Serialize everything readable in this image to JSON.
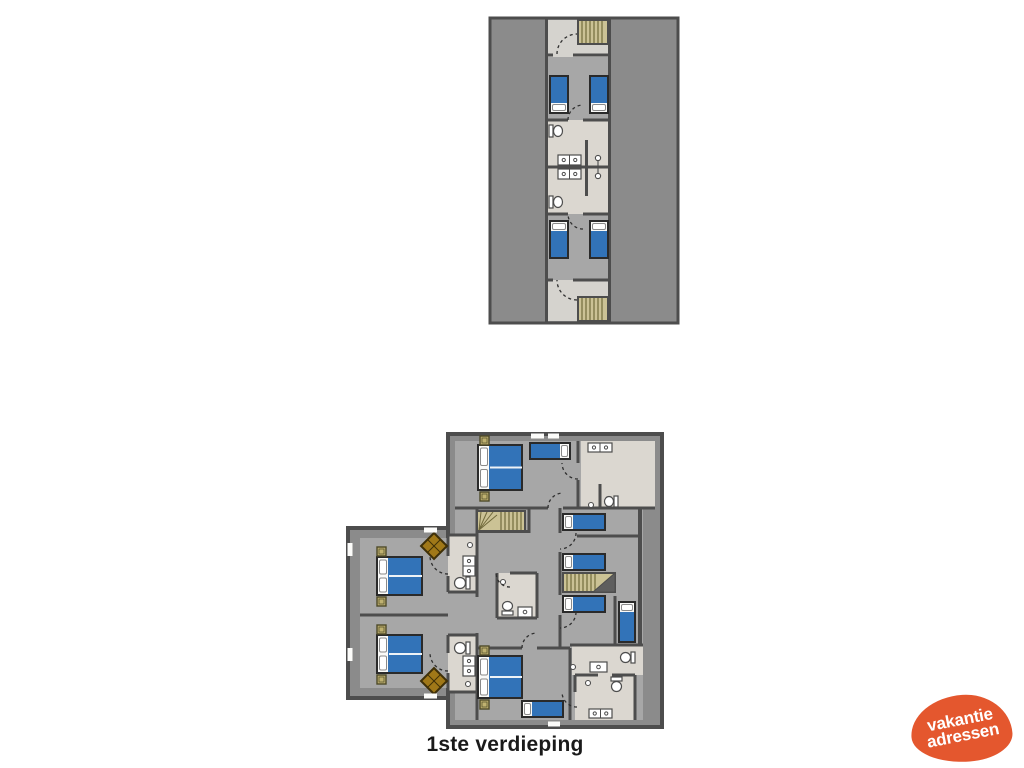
{
  "caption": {
    "text": "1ste verdieping"
  },
  "logo": {
    "line1": "vakantie",
    "line2": "adressen",
    "color": "#e4572e",
    "text_color": "#ffffff"
  },
  "palette": {
    "roof": "#8b8b8b",
    "wall": "#4d4d4d",
    "floor": "#a7a7a7",
    "hall": "#d5d3ce",
    "bath": "#dbd7d0",
    "bed_blue": "#3273b8",
    "bed_blue_dark": "#1e4c86",
    "linen": "#fafaf8",
    "stair_fill": "#cbc295",
    "stair_line": "#716a3c",
    "stair_tri": "#5e5e5e",
    "nightstand": "#bfb170",
    "wood": "#a07818",
    "wood_dark": "#3f3008",
    "white": "#fcfcfa",
    "fixture_stroke": "#4d4d4d",
    "arc": "#2f2f2f"
  },
  "plans": [
    {
      "name": "upper-floor-plan",
      "items": [
        {
          "t": "rect",
          "x": 490,
          "y": 18,
          "w": 188,
          "h": 305,
          "f": "roof",
          "s": "wall",
          "sw": 3,
          "n": "roof-area"
        },
        {
          "t": "rect",
          "x": 548,
          "y": 20,
          "w": 60,
          "h": 37,
          "f": "hall",
          "n": "hallway-floor"
        },
        {
          "t": "rect",
          "x": 548,
          "y": 57,
          "w": 60,
          "h": 63,
          "f": "floor",
          "n": "bedroom-floor"
        },
        {
          "t": "rect",
          "x": 548,
          "y": 120,
          "w": 60,
          "h": 94,
          "f": "bath",
          "n": "bathroom-floor"
        },
        {
          "t": "rect",
          "x": 548,
          "y": 214,
          "w": 60,
          "h": 66,
          "f": "floor",
          "n": "bedroom-floor"
        },
        {
          "t": "rect",
          "x": 548,
          "y": 280,
          "w": 60,
          "h": 41,
          "f": "hall",
          "n": "hallway-floor"
        },
        {
          "t": "line",
          "x1": 546.5,
          "y1": 18,
          "x2": 546.5,
          "y2": 323,
          "w": 3
        },
        {
          "t": "line",
          "x1": 609.5,
          "y1": 18,
          "x2": 609.5,
          "y2": 323,
          "w": 3
        },
        {
          "t": "stairs",
          "x": 578,
          "y": 20,
          "w": 30,
          "h": 24,
          "o": "v"
        },
        {
          "t": "line",
          "x1": 548,
          "y1": 55,
          "x2": 553,
          "y2": 55,
          "w": 3
        },
        {
          "t": "line",
          "x1": 573,
          "y1": 55,
          "x2": 608,
          "y2": 55,
          "w": 3
        },
        {
          "t": "line",
          "x1": 548,
          "y1": 120,
          "x2": 568,
          "y2": 120,
          "w": 3
        },
        {
          "t": "line",
          "x1": 583,
          "y1": 120,
          "x2": 608,
          "y2": 120,
          "w": 3
        },
        {
          "t": "line",
          "x1": 548,
          "y1": 167,
          "x2": 608,
          "y2": 167,
          "w": 3
        },
        {
          "t": "line",
          "x1": 548,
          "y1": 214,
          "x2": 568,
          "y2": 214,
          "w": 3
        },
        {
          "t": "line",
          "x1": 583,
          "y1": 214,
          "x2": 608,
          "y2": 214,
          "w": 3
        },
        {
          "t": "line",
          "x1": 548,
          "y1": 280,
          "x2": 553,
          "y2": 280,
          "w": 3
        },
        {
          "t": "line",
          "x1": 573,
          "y1": 280,
          "x2": 608,
          "y2": 280,
          "w": 3
        },
        {
          "t": "line",
          "x1": 586.5,
          "y1": 140,
          "x2": 586.5,
          "y2": 196,
          "w": 3
        },
        {
          "t": "bed",
          "x": 550,
          "y": 76,
          "w": 18,
          "h": 37,
          "p": "b"
        },
        {
          "t": "bed",
          "x": 590,
          "y": 76,
          "w": 18,
          "h": 37,
          "p": "b"
        },
        {
          "t": "bed",
          "x": 550,
          "y": 221,
          "w": 18,
          "h": 37,
          "p": "t"
        },
        {
          "t": "bed",
          "x": 590,
          "y": 221,
          "w": 18,
          "h": 37,
          "p": "t"
        },
        {
          "t": "wc",
          "x": 549,
          "y": 125,
          "w": 14,
          "h": 12,
          "o": "e"
        },
        {
          "t": "wc",
          "x": 549,
          "y": 196,
          "w": 14,
          "h": 12,
          "o": "e"
        },
        {
          "t": "sink2",
          "x": 558,
          "y": 155,
          "w": 23,
          "h": 10
        },
        {
          "t": "sink2",
          "x": 558,
          "y": 169,
          "w": 23,
          "h": 10
        },
        {
          "t": "shower",
          "x": 598,
          "y": 167
        },
        {
          "t": "stairs",
          "x": 578,
          "y": 297,
          "w": 30,
          "h": 24,
          "o": "v"
        },
        {
          "t": "arc",
          "x": 577,
          "y": 54,
          "r": 20,
          "a0": 180,
          "a1": 270
        },
        {
          "t": "arc",
          "x": 583,
          "y": 120,
          "r": 15,
          "a0": 180,
          "a1": 270
        },
        {
          "t": "arc",
          "x": 583,
          "y": 214,
          "r": 15,
          "a0": 90,
          "a1": 180
        },
        {
          "t": "arc",
          "x": 577,
          "y": 280,
          "r": 20,
          "a0": 90,
          "a1": 180
        }
      ]
    },
    {
      "name": "first-floor-plan",
      "items": [
        {
          "t": "rect",
          "x": 448,
          "y": 434,
          "w": 214,
          "h": 293,
          "f": "roof",
          "s": "wall",
          "sw": 4,
          "n": "roof-area"
        },
        {
          "t": "rect",
          "x": 348,
          "y": 528,
          "w": 100,
          "h": 170,
          "f": "roof",
          "s": "wall",
          "sw": 4,
          "n": "roof-area"
        },
        {
          "t": "rect",
          "x": 455,
          "y": 441,
          "w": 200,
          "h": 279,
          "f": "floor",
          "n": "floor-area"
        },
        {
          "t": "rect",
          "x": 360,
          "y": 538,
          "w": 95,
          "h": 150,
          "f": "floor",
          "n": "left-wing-floor"
        },
        {
          "t": "rect",
          "x": 643,
          "y": 508,
          "w": 12,
          "h": 212,
          "f": "roof",
          "n": "roof-strip"
        },
        {
          "t": "rect",
          "x": 581,
          "y": 441,
          "w": 74,
          "h": 67,
          "f": "bath",
          "n": "bathroom-floor"
        },
        {
          "t": "rect",
          "x": 497,
          "y": 573,
          "w": 40,
          "h": 45,
          "f": "bath",
          "n": "bathroom-floor"
        },
        {
          "t": "rect",
          "x": 448,
          "y": 535,
          "w": 29,
          "h": 57,
          "f": "bath",
          "n": "bathroom-floor"
        },
        {
          "t": "rect",
          "x": 448,
          "y": 635,
          "w": 29,
          "h": 57,
          "f": "bath",
          "n": "bathroom-floor"
        },
        {
          "t": "rect",
          "x": 572,
          "y": 645,
          "w": 71,
          "h": 30,
          "f": "bath",
          "n": "bathroom-floor"
        },
        {
          "t": "rect",
          "x": 575,
          "y": 675,
          "w": 60,
          "h": 45,
          "f": "bath",
          "n": "bathroom-floor"
        },
        {
          "t": "line",
          "x1": 578,
          "y1": 441,
          "x2": 578,
          "y2": 463,
          "w": 3
        },
        {
          "t": "line",
          "x1": 578,
          "y1": 480,
          "x2": 578,
          "y2": 508,
          "w": 3
        },
        {
          "t": "line",
          "x1": 600,
          "y1": 484,
          "x2": 600,
          "y2": 508,
          "w": 3
        },
        {
          "t": "line",
          "x1": 455,
          "y1": 508,
          "x2": 548,
          "y2": 508,
          "w": 3
        },
        {
          "t": "line",
          "x1": 563,
          "y1": 508,
          "x2": 655,
          "y2": 508,
          "w": 3
        },
        {
          "t": "line",
          "x1": 477,
          "y1": 531.5,
          "x2": 529,
          "y2": 531.5,
          "w": 3
        },
        {
          "t": "line",
          "x1": 529,
          "y1": 508,
          "x2": 529,
          "y2": 533,
          "w": 3
        },
        {
          "t": "line",
          "x1": 477,
          "y1": 508,
          "x2": 477,
          "y2": 597,
          "w": 3
        },
        {
          "t": "line",
          "x1": 477,
          "y1": 633,
          "x2": 477,
          "y2": 720,
          "w": 3
        },
        {
          "t": "line",
          "x1": 448,
          "y1": 535,
          "x2": 477,
          "y2": 535,
          "w": 3
        },
        {
          "t": "line",
          "x1": 448,
          "y1": 592,
          "x2": 477,
          "y2": 592,
          "w": 3
        },
        {
          "t": "line",
          "x1": 448,
          "y1": 635,
          "x2": 477,
          "y2": 635,
          "w": 3
        },
        {
          "t": "line",
          "x1": 448,
          "y1": 692,
          "x2": 477,
          "y2": 692,
          "w": 3
        },
        {
          "t": "line",
          "x1": 448,
          "y1": 535,
          "x2": 448,
          "y2": 556,
          "w": 3
        },
        {
          "t": "line",
          "x1": 448,
          "y1": 576,
          "x2": 448,
          "y2": 592,
          "w": 3
        },
        {
          "t": "line",
          "x1": 448,
          "y1": 635,
          "x2": 448,
          "y2": 653,
          "w": 3
        },
        {
          "t": "line",
          "x1": 448,
          "y1": 673,
          "x2": 448,
          "y2": 692,
          "w": 3
        },
        {
          "t": "line",
          "x1": 360,
          "y1": 615,
          "x2": 448,
          "y2": 615,
          "w": 3
        },
        {
          "t": "line",
          "x1": 560,
          "y1": 508,
          "x2": 560,
          "y2": 533,
          "w": 3
        },
        {
          "t": "line",
          "x1": 560,
          "y1": 552,
          "x2": 560,
          "y2": 595,
          "w": 3
        },
        {
          "t": "line",
          "x1": 560,
          "y1": 615,
          "x2": 560,
          "y2": 648,
          "w": 3
        },
        {
          "t": "line",
          "x1": 577,
          "y1": 536,
          "x2": 640,
          "y2": 536,
          "w": 3
        },
        {
          "t": "line",
          "x1": 640,
          "y1": 508,
          "x2": 640,
          "y2": 645,
          "w": 4
        },
        {
          "t": "line",
          "x1": 615,
          "y1": 596,
          "x2": 615,
          "y2": 645,
          "w": 3
        },
        {
          "t": "line",
          "x1": 570,
          "y1": 645,
          "x2": 643,
          "y2": 645,
          "w": 3
        },
        {
          "t": "line",
          "x1": 570,
          "y1": 648,
          "x2": 570,
          "y2": 720,
          "w": 3
        },
        {
          "t": "line",
          "x1": 477,
          "y1": 648,
          "x2": 522,
          "y2": 648,
          "w": 3
        },
        {
          "t": "line",
          "x1": 537,
          "y1": 648,
          "x2": 570,
          "y2": 648,
          "w": 3
        },
        {
          "t": "line",
          "x1": 575,
          "y1": 675,
          "x2": 598,
          "y2": 675,
          "w": 3
        },
        {
          "t": "line",
          "x1": 612,
          "y1": 675,
          "x2": 635,
          "y2": 675,
          "w": 3
        },
        {
          "t": "line",
          "x1": 635,
          "y1": 675,
          "x2": 635,
          "y2": 720,
          "w": 3
        },
        {
          "t": "line",
          "x1": 575,
          "y1": 675,
          "x2": 575,
          "y2": 692,
          "w": 3
        },
        {
          "t": "line",
          "x1": 510,
          "y1": 573,
          "x2": 537,
          "y2": 573,
          "w": 3
        },
        {
          "t": "line",
          "x1": 497,
          "y1": 573,
          "x2": 497,
          "y2": 618,
          "w": 3
        },
        {
          "t": "line",
          "x1": 497,
          "y1": 618,
          "x2": 537,
          "y2": 618,
          "w": 3
        },
        {
          "t": "line",
          "x1": 537,
          "y1": 573,
          "x2": 537,
          "y2": 618,
          "w": 3
        },
        {
          "t": "stairs",
          "x": 477,
          "y": 511,
          "w": 48,
          "h": 20,
          "o": "v",
          "fan": "w"
        },
        {
          "t": "stairs",
          "x": 563,
          "y": 573,
          "w": 52,
          "h": 19,
          "o": "v",
          "tri": "e"
        },
        {
          "t": "bed",
          "x": 478,
          "y": 445,
          "w": 44,
          "h": 45,
          "p": "l",
          "d": 1
        },
        {
          "t": "bed",
          "x": 530,
          "y": 443,
          "w": 40,
          "h": 16,
          "p": "r"
        },
        {
          "t": "bed",
          "x": 563,
          "y": 514,
          "w": 42,
          "h": 16,
          "p": "l"
        },
        {
          "t": "bed",
          "x": 563,
          "y": 554,
          "w": 42,
          "h": 16,
          "p": "l"
        },
        {
          "t": "bed",
          "x": 563,
          "y": 596,
          "w": 42,
          "h": 16,
          "p": "l"
        },
        {
          "t": "bed",
          "x": 619,
          "y": 602,
          "w": 16,
          "h": 40,
          "p": "t"
        },
        {
          "t": "bed",
          "x": 377,
          "y": 557,
          "w": 45,
          "h": 38,
          "p": "l",
          "d": 1
        },
        {
          "t": "bed",
          "x": 377,
          "y": 635,
          "w": 45,
          "h": 38,
          "p": "l",
          "d": 1
        },
        {
          "t": "bed",
          "x": 478,
          "y": 656,
          "w": 44,
          "h": 42,
          "p": "l",
          "d": 1
        },
        {
          "t": "bed",
          "x": 522,
          "y": 701,
          "w": 41,
          "h": 16,
          "p": "l"
        },
        {
          "t": "ns",
          "x": 480,
          "y": 436
        },
        {
          "t": "ns",
          "x": 480,
          "y": 492
        },
        {
          "t": "ns",
          "x": 377,
          "y": 547
        },
        {
          "t": "ns",
          "x": 377,
          "y": 597
        },
        {
          "t": "ns",
          "x": 377,
          "y": 625
        },
        {
          "t": "ns",
          "x": 377,
          "y": 675
        },
        {
          "t": "ns",
          "x": 480,
          "y": 646
        },
        {
          "t": "ns",
          "x": 480,
          "y": 700
        },
        {
          "t": "diamond",
          "x": 434,
          "y": 546,
          "s": 13
        },
        {
          "t": "diamond",
          "x": 434,
          "y": 681,
          "s": 13
        },
        {
          "t": "sink2",
          "x": 588,
          "y": 443,
          "w": 24,
          "h": 9
        },
        {
          "t": "wc",
          "x": 604,
          "y": 496,
          "w": 14,
          "h": 11,
          "o": "w"
        },
        {
          "t": "knob",
          "x": 591,
          "y": 505
        },
        {
          "t": "wc",
          "x": 502,
          "y": 601,
          "w": 11,
          "h": 14,
          "o": "n"
        },
        {
          "t": "sink",
          "x": 518,
          "y": 607,
          "w": 14,
          "h": 10
        },
        {
          "t": "knob",
          "x": 503,
          "y": 582
        },
        {
          "t": "knob",
          "x": 470,
          "y": 545
        },
        {
          "t": "sink2",
          "x": 463,
          "y": 556,
          "w": 12,
          "h": 20,
          "o": "v"
        },
        {
          "t": "wc",
          "x": 454,
          "y": 577,
          "w": 16,
          "h": 12,
          "o": "w"
        },
        {
          "t": "wc",
          "x": 454,
          "y": 642,
          "w": 16,
          "h": 12,
          "o": "w"
        },
        {
          "t": "sink2",
          "x": 463,
          "y": 656,
          "w": 12,
          "h": 20,
          "o": "v"
        },
        {
          "t": "knob",
          "x": 468,
          "y": 684
        },
        {
          "t": "sink",
          "x": 590,
          "y": 662,
          "w": 17,
          "h": 10
        },
        {
          "t": "wc",
          "x": 620,
          "y": 652,
          "w": 15,
          "h": 11,
          "o": "w"
        },
        {
          "t": "knob",
          "x": 573,
          "y": 667
        },
        {
          "t": "wc",
          "x": 611,
          "y": 677,
          "w": 11,
          "h": 15,
          "o": "s"
        },
        {
          "t": "knob",
          "x": 588,
          "y": 683
        },
        {
          "t": "sink2",
          "x": 589,
          "y": 709,
          "w": 23,
          "h": 9
        },
        {
          "t": "win",
          "x": 531,
          "y": 433.5,
          "w": 13,
          "h": 5
        },
        {
          "t": "win",
          "x": 548,
          "y": 433.5,
          "w": 11,
          "h": 5
        },
        {
          "t": "win",
          "x": 548,
          "y": 721.5,
          "w": 12,
          "h": 5
        },
        {
          "t": "win",
          "x": 424,
          "y": 527.5,
          "w": 13,
          "h": 5
        },
        {
          "t": "win",
          "x": 424,
          "y": 693.5,
          "w": 13,
          "h": 5
        },
        {
          "t": "win",
          "x": 347.5,
          "y": 543,
          "w": 5,
          "h": 13
        },
        {
          "t": "win",
          "x": 347.5,
          "y": 648,
          "w": 5,
          "h": 13
        },
        {
          "t": "arc",
          "x": 563,
          "y": 508,
          "r": 15,
          "a0": 180,
          "a1": 270
        },
        {
          "t": "arc",
          "x": 578,
          "y": 463,
          "r": 16,
          "a0": 90,
          "a1": 180
        },
        {
          "t": "arc",
          "x": 560,
          "y": 533,
          "r": 16,
          "a0": 0,
          "a1": 90
        },
        {
          "t": "arc",
          "x": 560,
          "y": 612,
          "r": 16,
          "a0": 0,
          "a1": 90
        },
        {
          "t": "arc",
          "x": 510,
          "y": 573,
          "r": 14,
          "a0": 90,
          "a1": 180
        },
        {
          "t": "arc",
          "x": 448,
          "y": 556,
          "r": 18,
          "a0": 90,
          "a1": 180
        },
        {
          "t": "arc",
          "x": 448,
          "y": 653,
          "r": 18,
          "a0": 90,
          "a1": 180
        },
        {
          "t": "arc",
          "x": 537,
          "y": 648,
          "r": 15,
          "a0": 180,
          "a1": 270
        },
        {
          "t": "arc",
          "x": 577,
          "y": 692,
          "r": 15,
          "a0": 90,
          "a1": 180
        }
      ]
    }
  ]
}
